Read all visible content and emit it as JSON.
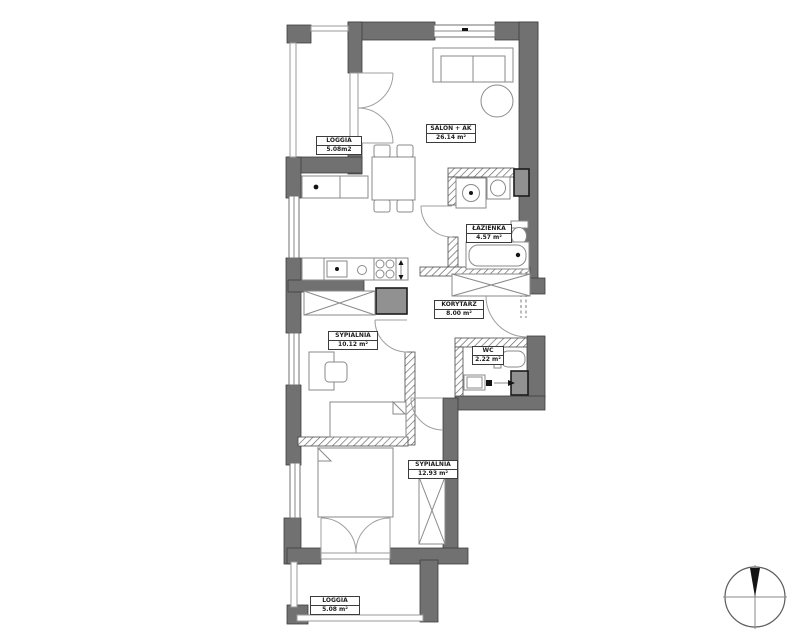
{
  "plan": {
    "title": "apartment-floor-plan",
    "rooms": [
      {
        "id": "loggia-top",
        "name": "LOGGIA",
        "area": "5.08m2"
      },
      {
        "id": "salon",
        "name": "SALON + AK",
        "area": "26.14 m²"
      },
      {
        "id": "lazienka",
        "name": "ŁAZIENKA",
        "area": "4.57 m²"
      },
      {
        "id": "korytarz",
        "name": "KORYTARZ",
        "area": "8.00 m²"
      },
      {
        "id": "wc",
        "name": "WC",
        "area": "2.22 m²"
      },
      {
        "id": "sypialnia-1",
        "name": "SYPIALNIA",
        "area": "10.12 m²"
      },
      {
        "id": "sypialnia-2",
        "name": "SYPIALNIA",
        "area": "12.93 m²"
      },
      {
        "id": "loggia-bottom",
        "name": "LOGGIA",
        "area": "5.08 m²"
      }
    ],
    "colors": {
      "wall": "#717171",
      "shaft": "#919191",
      "furniture_line": "#8a8a8a",
      "background": "#ffffff"
    },
    "symbols": [
      "sofa",
      "round-table",
      "dining-table",
      "kitchen-counter",
      "cooktop",
      "kitchen-sink",
      "washing-machine",
      "bathroom-sink",
      "toilet",
      "bathtub",
      "bed",
      "desk",
      "chair",
      "wardrobe-cross",
      "door-swing",
      "french-door",
      "window",
      "railing",
      "shaft",
      "entrance-arrow",
      "compass-north"
    ]
  }
}
